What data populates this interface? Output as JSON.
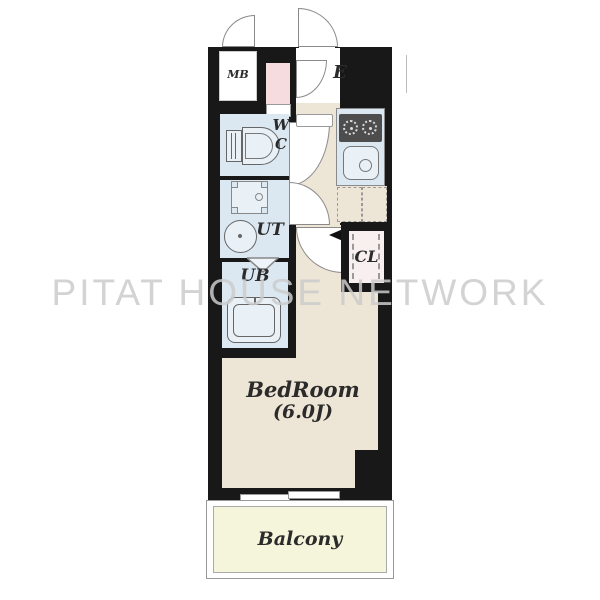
{
  "watermark": "PITAT HOUSE NETWORK",
  "rooms": {
    "meter_box": {
      "label": "MB"
    },
    "entrance": {
      "label": "E"
    },
    "toilet": {
      "label_line1": "W",
      "label_line2": "C"
    },
    "utility": {
      "label": "UT"
    },
    "unit_bath": {
      "label": "UB"
    },
    "closet": {
      "label": "CL"
    },
    "bedroom": {
      "label": "BedRoom",
      "size": "(6.0J)"
    },
    "balcony": {
      "label": "Balcony"
    }
  },
  "colors": {
    "wall": "#181818",
    "wet_room_floor": "#dbe8f1",
    "hall_bedroom_floor": "#ede5d5",
    "pink_box": "#f6dcde",
    "closet_floor": "#f8f0ee",
    "balcony_floor": "#f5f5db",
    "outline": "#8a8a8a",
    "watermark_gray": "#cbcbcb"
  }
}
